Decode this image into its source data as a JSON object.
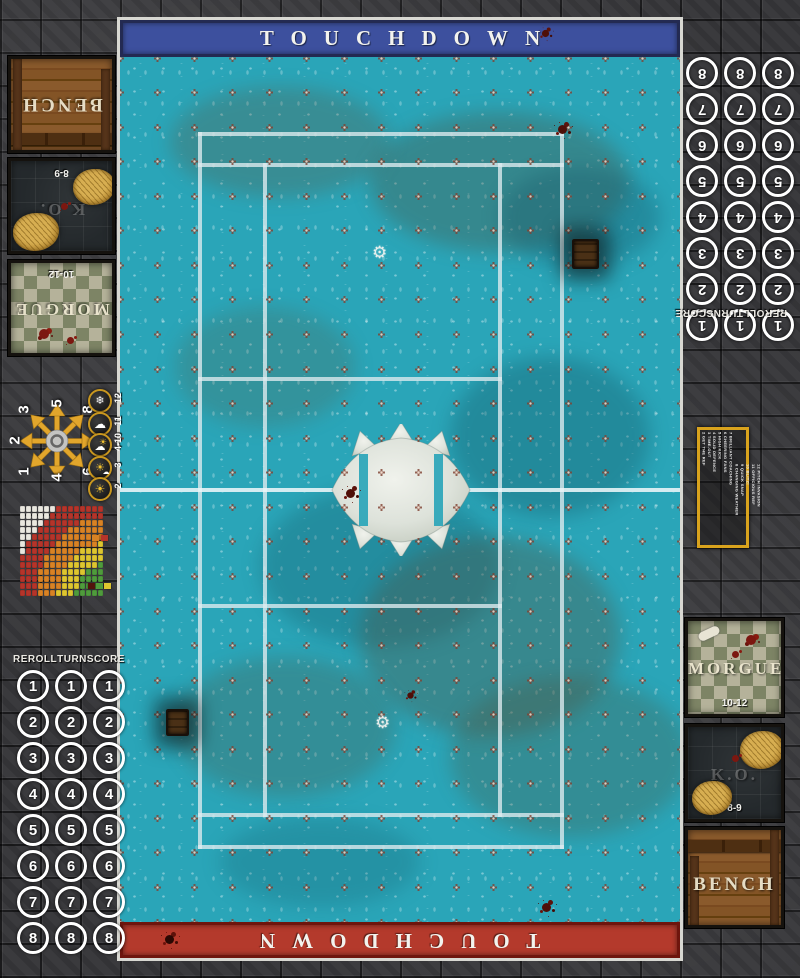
{
  "mat": {
    "banner_top": "TOUCHDOWN",
    "banner_bottom": "TOUCHDOWN",
    "colors": {
      "pitch_teal": "#2aa5b8",
      "banner_blue": "#3d509e",
      "banner_red": "#b43a2c",
      "line_white": "#dfecef",
      "stone_grey": "#3a3a3d",
      "gold_border": "#d9a31d"
    }
  },
  "dugouts": {
    "left": {
      "bench_label": "BENCH",
      "ko_label": "K.O.",
      "ko_range": "8-9",
      "morgue_label": "MORGUE",
      "morgue_range": "10-12"
    },
    "right": {
      "bench_label": "BENCH",
      "ko_label": "K.O.",
      "ko_range": "8-9",
      "morgue_label": "MORGUE",
      "morgue_range": "10-12"
    }
  },
  "score_track": {
    "header_words": [
      "REROLL",
      "TURN",
      "SCORE"
    ],
    "numbers": [
      1,
      2,
      3,
      4,
      5,
      6,
      7,
      8
    ],
    "columns_per_row": 3
  },
  "scatter_template": {
    "grid": [
      [
        "3",
        "5",
        "8"
      ],
      [
        "2",
        "",
        "7"
      ],
      [
        "1",
        "4",
        "6"
      ]
    ]
  },
  "weather_table": {
    "rows": [
      {
        "value": "12",
        "icon": "blizzard-icon"
      },
      {
        "value": "11",
        "icon": "rain-cloud-icon"
      },
      {
        "value": "4-10",
        "icon": "sun-behind-cloud-icon"
      },
      {
        "value": "3",
        "icon": "sun-small-cloud-icon"
      },
      {
        "value": "2",
        "icon": "sun-icon"
      }
    ]
  },
  "kickoff_table": {
    "column1": [
      "2 GET THE REF",
      "3 TIME-OUT",
      "4 SOLID DEFENCE",
      "5 HIGH KICK",
      "6 CHEERING FANS",
      "7 BRILLIANT COACHING"
    ],
    "column2": [
      "8 CHANGING WEATHER",
      "9 QUICK SNAP",
      "10 BLITZ!",
      "11 OFFICIOUS REF",
      "12 PITCH INVASION"
    ]
  },
  "chart_data": {
    "type": "heatmap",
    "title": "pass-range-ruler",
    "cols": 14,
    "rows": 13,
    "origin": "bottom-right",
    "bands": [
      {
        "name": "quick-pass",
        "color": "#4f9b3c",
        "max_distance": 4
      },
      {
        "name": "short-pass",
        "color": "#ddc52f",
        "max_distance": 7
      },
      {
        "name": "long-pass",
        "color": "#d88224",
        "max_distance": 10.5
      },
      {
        "name": "long-bomb",
        "color": "#b5342a",
        "max_distance": 14
      },
      {
        "name": "out-of-range",
        "color": "#e9e7df",
        "max_distance": 99
      }
    ]
  },
  "pitch": {
    "cross_grid": {
      "cols": 16,
      "rows": 26
    },
    "trapdoor_count": 2,
    "center_emblem": "spiked-ball-icon",
    "logo_icon": "gear-icon"
  }
}
